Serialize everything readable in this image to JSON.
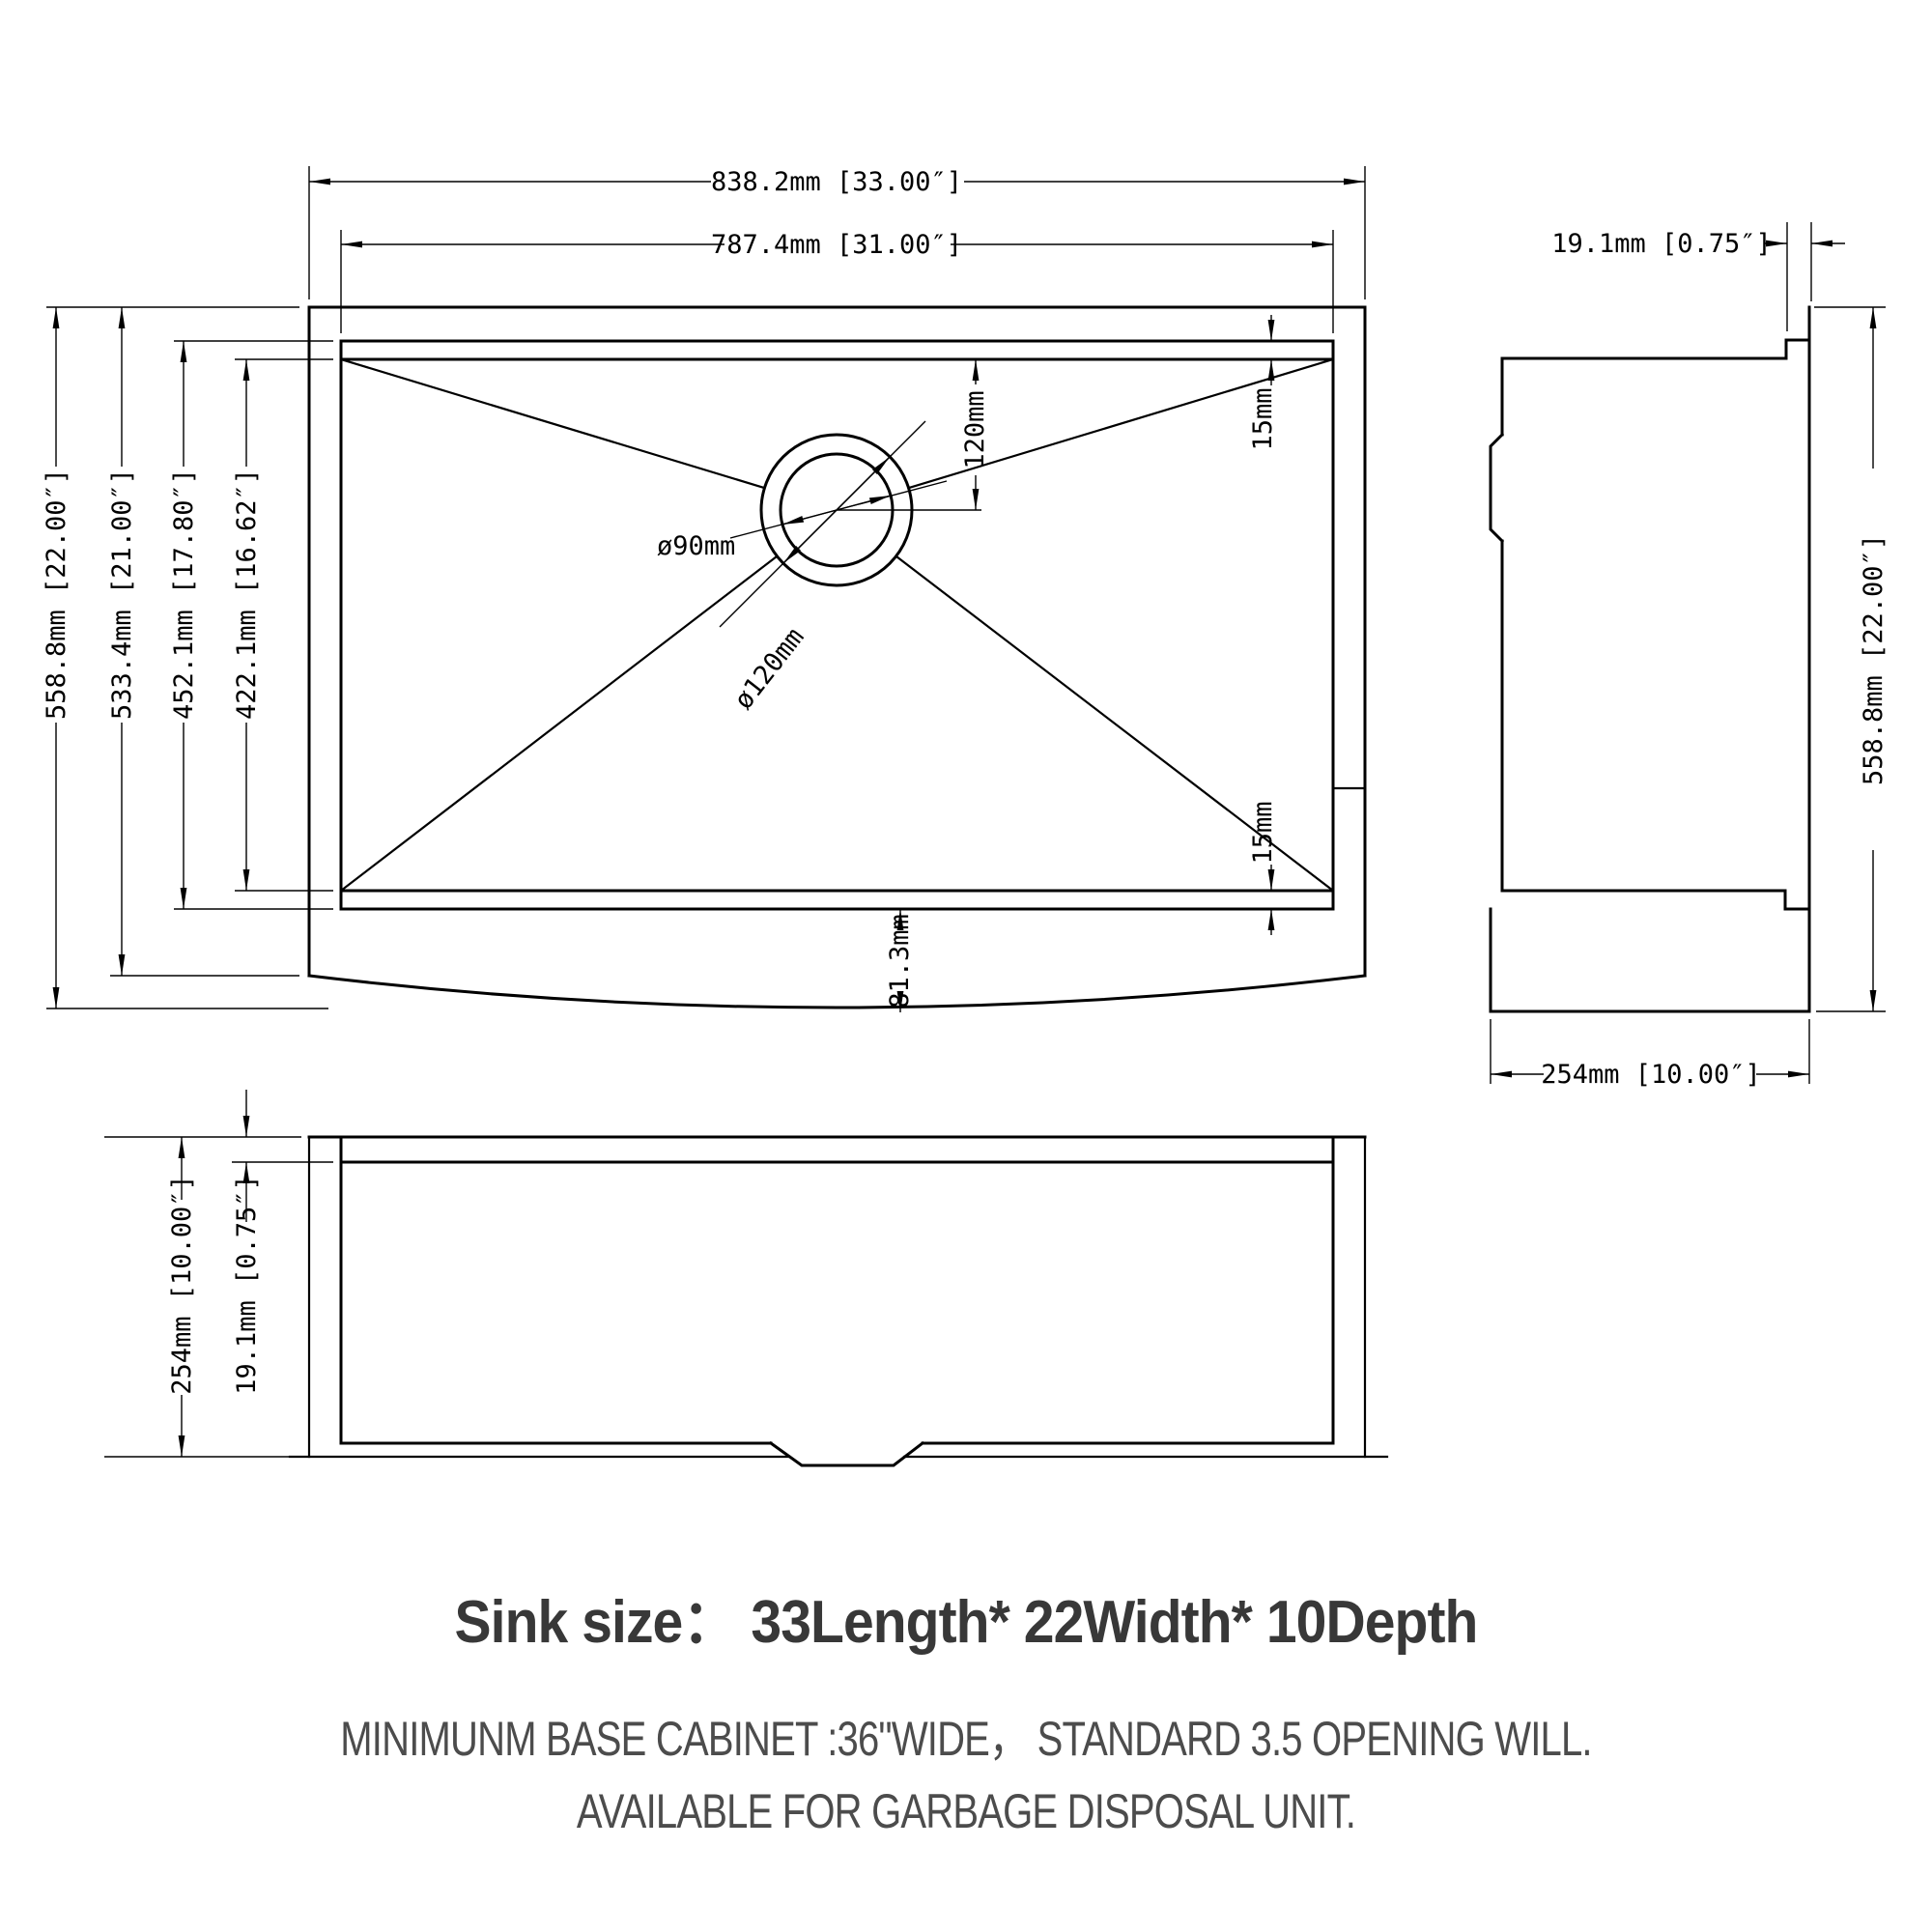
{
  "colors": {
    "line": "#000000",
    "dim_text": "#000000",
    "title_text": "#383838",
    "note_text": "#4c4c4c"
  },
  "plan_view": {
    "dim_overall_width": "838.2mm [33.00″]",
    "dim_inner_width": "787.4mm [31.00″]",
    "dim_overall_depth": "558.8mm [22.00″]",
    "dim_body_depth": "533.4mm [21.00″]",
    "dim_bowl_outer_depth": "452.1mm [17.80″]",
    "dim_bowl_inner_depth": "422.1mm [16.62″]",
    "dim_rim_top": "15mm",
    "dim_rim_bottom": "15mm",
    "dim_apron_bulge": "81.3mm",
    "drain": {
      "dim_offset": "120mm",
      "dim_inner_diameter": "ø90mm",
      "dim_outer_diameter": "ø120mm"
    }
  },
  "side_view": {
    "dim_apron_thickness": "19.1mm [0.75″]",
    "dim_overall_depth": "558.8mm [22.00″]",
    "dim_height": "254mm [10.00″]"
  },
  "front_view": {
    "dim_height": "254mm [10.00″]",
    "dim_rim_thickness": "19.1mm [0.75″]"
  },
  "footer": {
    "title": "Sink size：  33Length* 22Width* 10Depth",
    "note_line1": "MINIMUNM BASE CABINET :36\"WIDE，  STANDARD 3.5 OPENING WILL.",
    "note_line2": "AVAILABLE FOR GARBAGE DISPOSAL UNIT."
  }
}
